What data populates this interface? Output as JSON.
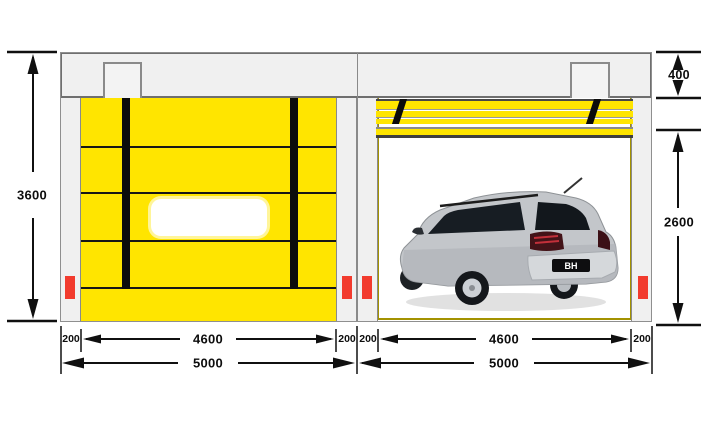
{
  "diagram": {
    "type": "engineering-elevation-diagram",
    "subject": "High-speed roll-up door: closed curtain view (left) and open view with car (right)",
    "colors": {
      "curtain_yellow": "#FFE500",
      "frame_gray": "#F0F0F0",
      "line_dark": "#101010",
      "sensor_red": "#F23B2E",
      "rail_olive": "#A39200"
    },
    "labels": {
      "total_height": "3600",
      "header_height": "400",
      "opening_height": "2600",
      "left_bay": {
        "margin_left": "200",
        "opening_width": "4600",
        "margin_right": "200",
        "total_width": "5000"
      },
      "right_bay": {
        "margin_left": "200",
        "opening_width": "4600",
        "margin_right": "200",
        "total_width": "5000"
      }
    },
    "car": {
      "license_plate": "BH"
    }
  }
}
